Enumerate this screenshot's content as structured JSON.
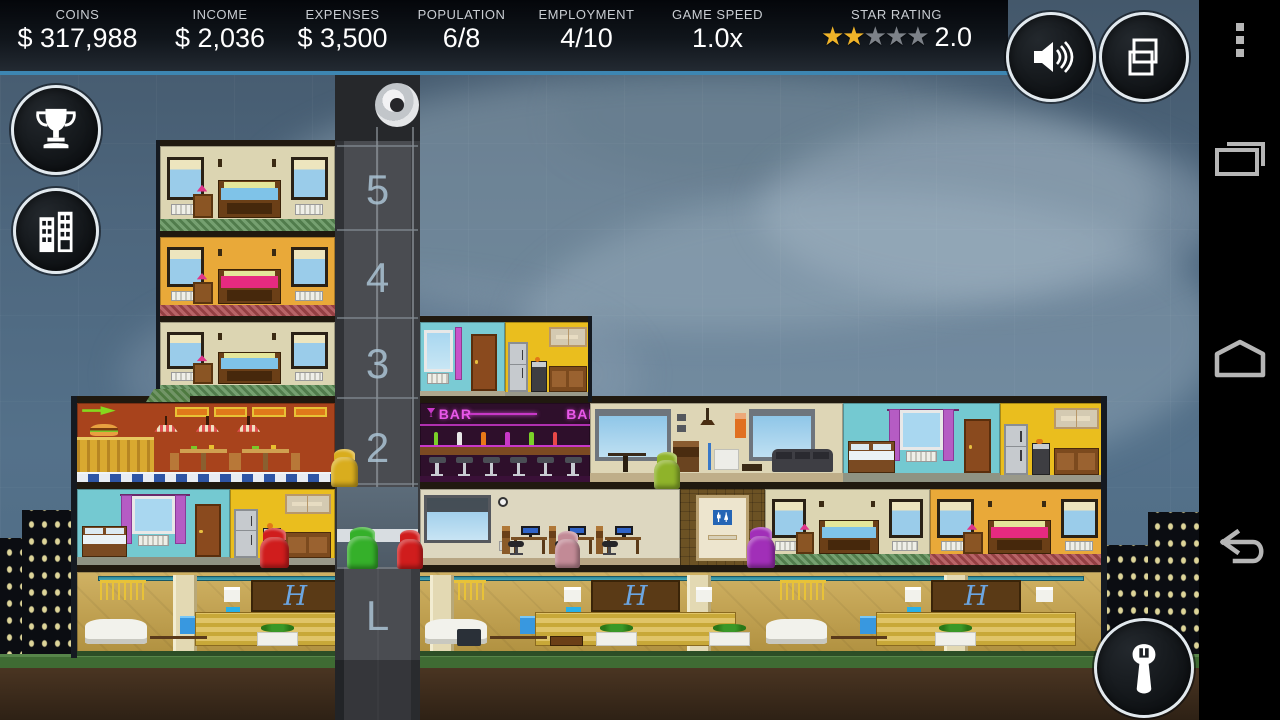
{
  "hud": {
    "stats": [
      {
        "id": "coins",
        "label": "COINS",
        "value": "$ 317,988",
        "w": 155
      },
      {
        "id": "income",
        "label": "INCOME",
        "value": "$ 2,036",
        "w": 130
      },
      {
        "id": "expenses",
        "label": "EXPENSES",
        "value": "$ 3,500",
        "w": 115
      },
      {
        "id": "population",
        "label": "POPULATION",
        "value": "6/8",
        "w": 123
      },
      {
        "id": "employment",
        "label": "EMPLOYMENT",
        "value": "4/10",
        "w": 127
      },
      {
        "id": "game-speed",
        "label": "GAME SPEED",
        "value": "1.0x",
        "w": 135
      }
    ],
    "star_rating": {
      "label": "STAR RATING",
      "value": "2.0",
      "filled": 2,
      "total": 5,
      "glyph": "★",
      "filled_color": "#F0B429",
      "empty_color": "#7D8289",
      "w": 223
    }
  },
  "action_buttons": [
    "achievements",
    "buildings",
    "sound",
    "screens",
    "tools"
  ],
  "nav_bar": {
    "icons": [
      "overflow-menu",
      "recent-apps",
      "home",
      "back"
    ]
  },
  "elevator": {
    "floor_labels": [
      {
        "text": "5",
        "y": 166
      },
      {
        "text": "4",
        "y": 254
      },
      {
        "text": "3",
        "y": 340
      },
      {
        "text": "2",
        "y": 424
      },
      {
        "text": "L",
        "y": 592
      }
    ],
    "line_ys": [
      145,
      229,
      317,
      397,
      483,
      567
    ],
    "car": {
      "x": 337,
      "y": 487,
      "w": 81,
      "h": 80
    }
  },
  "signs": {
    "bar": "BAR",
    "hotel_monogram": "H"
  },
  "palette": {
    "slab": "#20190F",
    "edge": "#151A21",
    "shaft": "#47494E",
    "shaft_edge": "#303236",
    "shaft_house": "#26282B",
    "grass": "#3F6B33",
    "dirt": "#4A3522",
    "dirt_dark": "#2E2115",
    "skyline": "#0B0D12",
    "skyline_window": "#E8DFA0",
    "car": "#57listed"
  },
  "scene": {
    "rooms": [
      {
        "name": "bedroom-floor5",
        "type": "bedroom",
        "x": 160,
        "y": 146,
        "w": 175,
        "h": 86,
        "wall": "#DCD5B2",
        "carpet": "#5E9059",
        "bed": "#7FC3E8"
      },
      {
        "name": "bedroom-floor4",
        "type": "bedroom",
        "x": 160,
        "y": 237,
        "w": 175,
        "h": 80,
        "wall": "#E9A939",
        "carpet": "#AC4A4E",
        "bed": "#E62A80"
      },
      {
        "name": "bedroom-floor3",
        "type": "bedroom",
        "x": 160,
        "y": 322,
        "w": 175,
        "h": 74,
        "wall": "#DCD5B2",
        "carpet": "#5E9059",
        "bed": "#7FC3E8"
      },
      {
        "name": "hallway-floor3",
        "type": "hall",
        "x": 420,
        "y": 322,
        "w": 85,
        "h": 78,
        "wall": "#7ACBD4"
      },
      {
        "name": "kitchen-floor3",
        "type": "kitchen",
        "x": 505,
        "y": 322,
        "w": 85,
        "h": 78,
        "wall": "#EABE1E"
      },
      {
        "name": "diner-floor2",
        "type": "restaurant",
        "x": 77,
        "y": 403,
        "w": 258,
        "h": 80,
        "wall": "#A8431C"
      },
      {
        "name": "bar-floor2",
        "type": "bar",
        "x": 420,
        "y": 403,
        "w": 170,
        "h": 80,
        "wall": "#2E0F2B"
      },
      {
        "name": "lounge-floor2",
        "type": "living",
        "x": 590,
        "y": 403,
        "w": 253,
        "h": 80,
        "wall": "#DED6B6"
      },
      {
        "name": "bedroom-floor2",
        "type": "cyanbed",
        "x": 843,
        "y": 403,
        "w": 157,
        "h": 80,
        "wall": "#74C9D1"
      },
      {
        "name": "kitchen-floor2",
        "type": "kitchen",
        "x": 1000,
        "y": 403,
        "w": 103,
        "h": 80,
        "wall": "#EABE1E"
      },
      {
        "name": "bedroom-floor1-left",
        "type": "cyanbed",
        "x": 77,
        "y": 489,
        "w": 153,
        "h": 77,
        "wall": "#74C9D1"
      },
      {
        "name": "kitchen-floor1",
        "type": "kitchen",
        "x": 230,
        "y": 489,
        "w": 105,
        "h": 77,
        "wall": "#EABE1E"
      },
      {
        "name": "office-floor1",
        "type": "office",
        "x": 420,
        "y": 489,
        "w": 260,
        "h": 77,
        "wall": "#DDD7C0"
      },
      {
        "name": "restroom-floor1",
        "type": "restroom",
        "x": 680,
        "y": 489,
        "w": 85,
        "h": 77,
        "wall": "#6C5224"
      },
      {
        "name": "bedroom-floor1-mid",
        "type": "bedroom",
        "x": 765,
        "y": 489,
        "w": 165,
        "h": 77,
        "wall": "#DCD5B2",
        "carpet": "#5E9059",
        "bed": "#7FC3E8"
      },
      {
        "name": "bedroom-floor1-right",
        "type": "bedroom",
        "x": 930,
        "y": 489,
        "w": 175,
        "h": 77,
        "wall": "#E9A939",
        "carpet": "#AC4A4E",
        "bed": "#E62A80"
      },
      {
        "name": "hotel-lobby",
        "type": "lobby",
        "x": 77,
        "y": 572,
        "w": 1028,
        "h": 84,
        "wall": "#C8A448"
      }
    ],
    "androids": [
      {
        "name": "android-yellow-waiting",
        "color": "#D9AD1E",
        "x": 331,
        "y": 449,
        "w": 27,
        "h": 38
      },
      {
        "name": "android-green-elevator",
        "color": "#35B02A",
        "x": 347,
        "y": 527,
        "w": 31,
        "h": 42
      },
      {
        "name": "android-red-elevator",
        "color": "#D01D1D",
        "x": 397,
        "y": 530,
        "w": 26,
        "h": 39
      },
      {
        "name": "android-red-kitchen",
        "color": "#D01D1D",
        "x": 260,
        "y": 528,
        "w": 29,
        "h": 40
      },
      {
        "name": "android-pink-office",
        "color": "#C28A96",
        "x": 555,
        "y": 531,
        "w": 25,
        "h": 37
      },
      {
        "name": "android-purple-restroom",
        "color": "#A12FB8",
        "x": 747,
        "y": 527,
        "w": 28,
        "h": 41
      },
      {
        "name": "android-green-lounge",
        "color": "#8FB32A",
        "x": 654,
        "y": 452,
        "w": 26,
        "h": 37
      }
    ],
    "slabs": [
      {
        "x": 156,
        "y": 140,
        "w": 182,
        "h": 6
      },
      {
        "x": 156,
        "y": 231,
        "w": 182,
        "h": 6
      },
      {
        "x": 156,
        "y": 316,
        "w": 182,
        "h": 6
      },
      {
        "x": 414,
        "y": 316,
        "w": 178,
        "h": 6
      },
      {
        "x": 71,
        "y": 396,
        "w": 269,
        "h": 7
      },
      {
        "x": 414,
        "y": 396,
        "w": 178,
        "h": 7
      },
      {
        "x": 584,
        "y": 396,
        "w": 523,
        "h": 7
      },
      {
        "x": 71,
        "y": 482,
        "w": 1036,
        "h": 7
      },
      {
        "x": 71,
        "y": 565,
        "w": 1036,
        "h": 7
      }
    ],
    "edges": [
      {
        "x": 156,
        "y": 140,
        "w": 4,
        "h": 262
      },
      {
        "x": 71,
        "y": 396,
        "w": 6,
        "h": 262
      },
      {
        "x": 1101,
        "y": 396,
        "w": 6,
        "h": 262
      },
      {
        "x": 588,
        "y": 316,
        "w": 4,
        "h": 86
      }
    ],
    "skyline": [
      {
        "x": 0,
        "y": 538,
        "w": 40,
        "h": 122
      },
      {
        "x": 22,
        "y": 510,
        "w": 56,
        "h": 150
      },
      {
        "x": 1098,
        "y": 545,
        "w": 62,
        "h": 115
      },
      {
        "x": 1148,
        "y": 512,
        "w": 68,
        "h": 148
      }
    ],
    "roof_garden": {
      "x": 146,
      "y": 389,
      "w": 44,
      "h": 13,
      "color": "#4E7A40"
    }
  }
}
